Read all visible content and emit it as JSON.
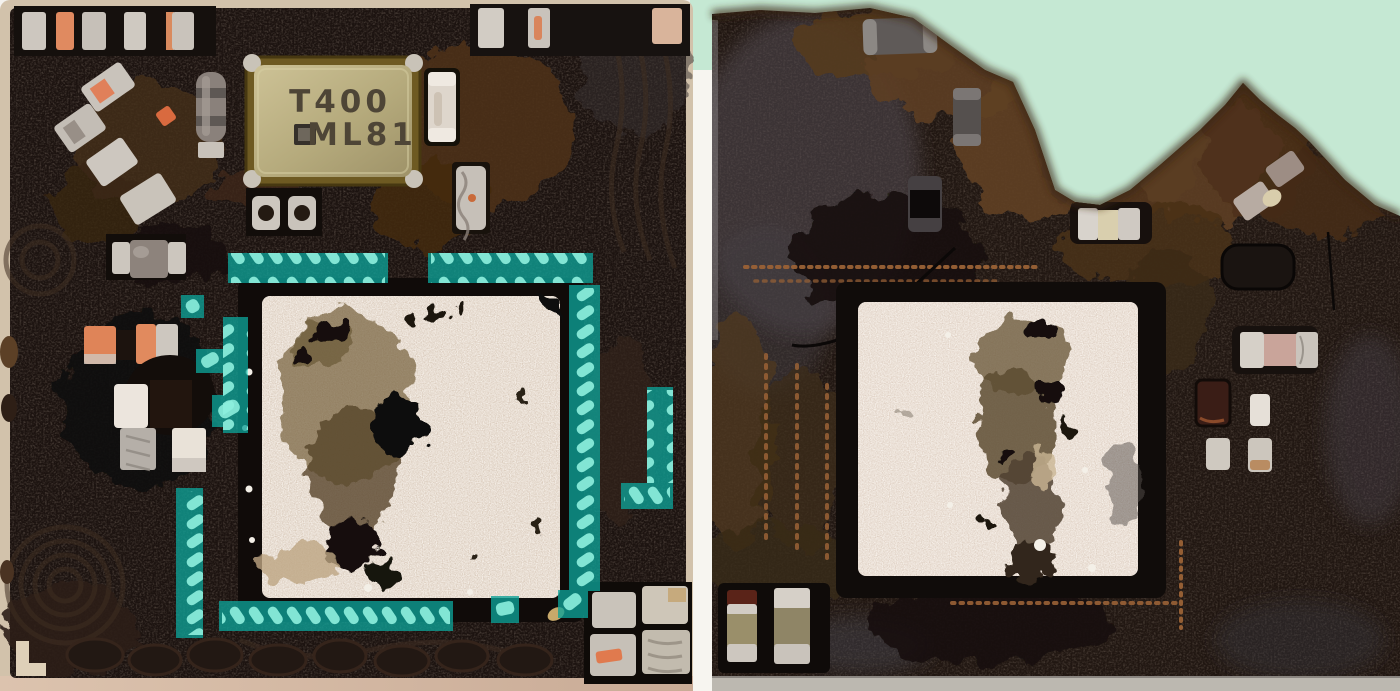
{
  "crystal": {
    "line1": "T400",
    "line2": "ML81"
  },
  "colors": {
    "mint_background": "#c5e8d3",
    "gap_white": "#f7f5f0",
    "substrate_tan": "#d2c2ab",
    "substrate_pink": "#d7b9a4",
    "board_dark_left": "#1c1310",
    "board_dark_right": "#211712",
    "char_brown": "#5c3e22",
    "pad_sparkle_left": "#d9cabb",
    "pad_sparkle_right": "#decfc2",
    "highlight_teal": "#0da298",
    "highlight_mark": "#8ceedd",
    "crystal_body": "#bdb284",
    "crystal_rim": "#6e5a22",
    "solder_silver": "#cdc7bf",
    "component_orange": "#e08a60",
    "component_gray": "#8d837c",
    "copper_dot": "#9a6236",
    "fiducial_cream": "#ded0b8"
  }
}
